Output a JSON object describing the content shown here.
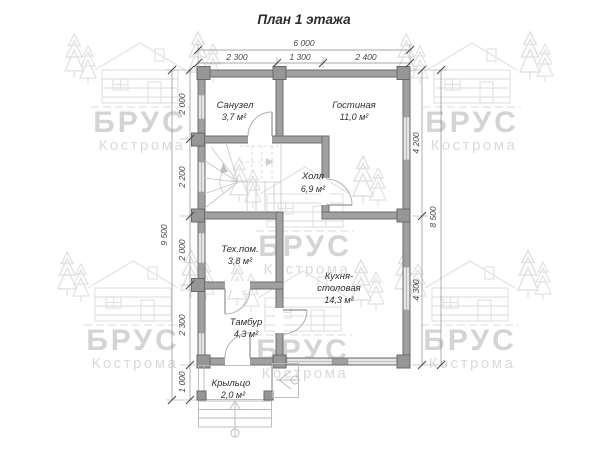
{
  "title": "План 1 этажа",
  "watermark": {
    "brand": "БРУС",
    "city": "Кострома"
  },
  "rooms": {
    "sanuzel": {
      "name": "Санузел",
      "area": "3,7 м²"
    },
    "gostinaya": {
      "name": "Гостиная",
      "area": "11,0 м²"
    },
    "holl": {
      "name": "Холл",
      "area": "6,9 м²"
    },
    "tehpom": {
      "name": "Тех.пом.",
      "area": "3,8 м²"
    },
    "kuhnya": {
      "line1": "Кухня-",
      "line2": "столовая",
      "area": "14,3 м²"
    },
    "tambur": {
      "name": "Тамбур",
      "area": "4,3 м²"
    },
    "krylco": {
      "name": "Крыльцо",
      "area": "2,0 м²"
    }
  },
  "dimensions": {
    "top_total": "6 000",
    "top_segments": [
      "2 300",
      "1 300",
      "2 400"
    ],
    "left_total": "9 500",
    "left_segments": [
      "2 000",
      "2 200",
      "2 000",
      "2 300",
      "1 000"
    ],
    "right_segments": [
      "4 200",
      "4 300"
    ],
    "right_total": "8 500"
  },
  "colors": {
    "wall": "#a0a0a0",
    "window": "#e6e6e6",
    "dimension_text": "#474747",
    "watermark": "#d4d4d4",
    "background": "#ffffff"
  }
}
